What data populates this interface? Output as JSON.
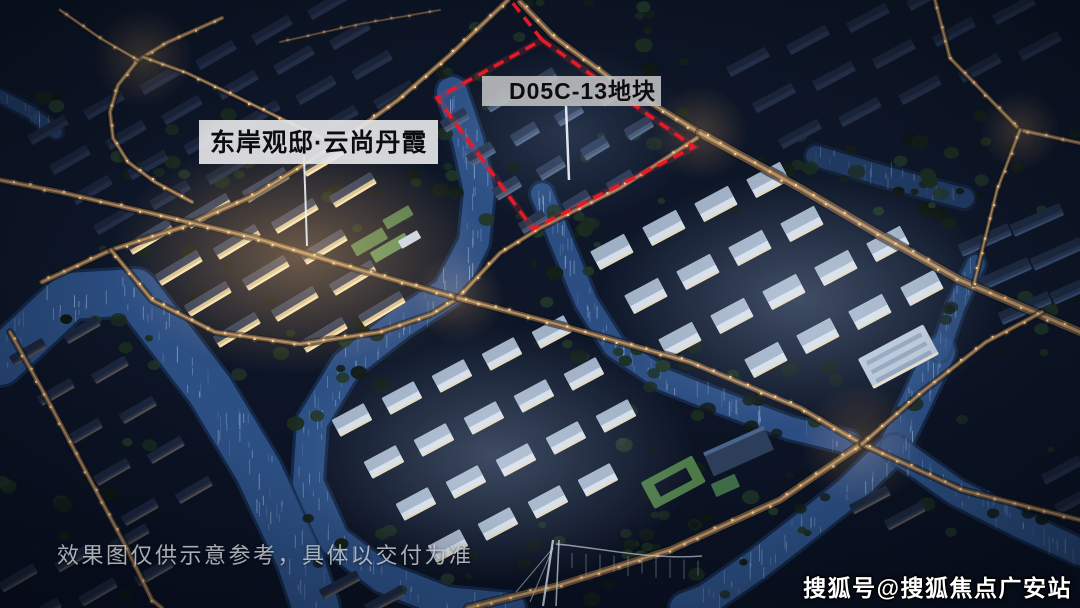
{
  "overlays": {
    "project_label": "东岸观邸·云尚丹霞",
    "plot_label": "D05C-13地块",
    "disclaimer": "效果图仅供示意参考，具体以交付为准",
    "source_credit": "搜狐号@搜狐焦点广安站"
  },
  "colors": {
    "plot_boundary_red": "#e81a26",
    "project_label_bg": "#e4e4e6",
    "plot_label_bg": "#bcbec0",
    "water_blue": "#2d5187",
    "road_light": "#c79d6c",
    "night_sky": "#0c1424"
  }
}
